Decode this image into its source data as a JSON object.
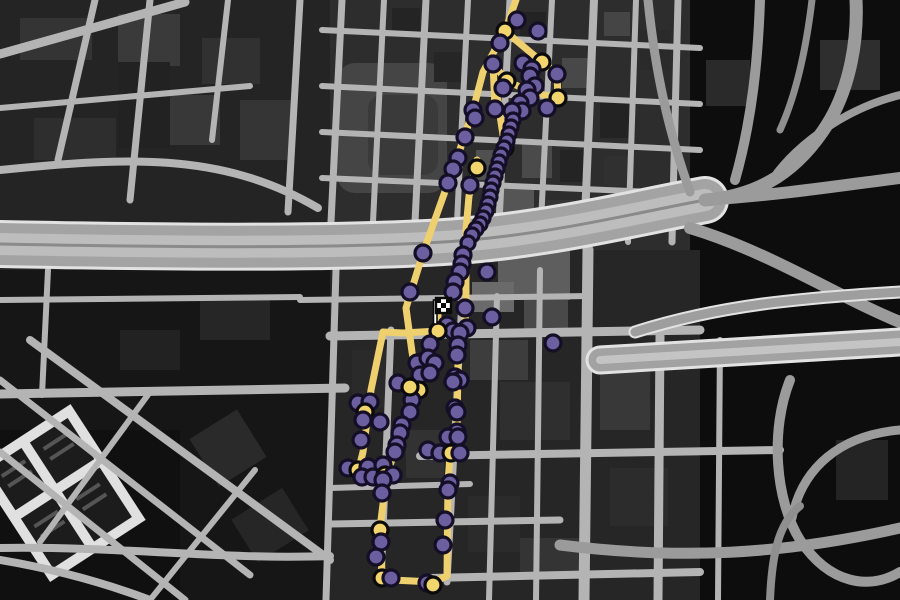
{
  "app": {
    "name": "gta-style-city-race-map",
    "view": "radar-map-fullscreen"
  },
  "map": {
    "colors": {
      "base": "#1f1f1f",
      "street": "#b4b4b4",
      "street_minor": "#a2a2a2",
      "freeway": "#a3a3a3",
      "freeway_edge": "#e2e2e2",
      "route": "#eed06f",
      "checkpoint_fill": "#6c5fa0",
      "checkpoint_stroke": "#140e27",
      "waypoint_fill": "#f3d56d",
      "waypoint_stroke": "#0b0b0b",
      "flag_white": "#ffffff",
      "flag_black": "#0a0a0a"
    },
    "flag": {
      "x": 431,
      "y": 296,
      "cols": 3,
      "rows": 3,
      "cell": 5
    },
    "route_segments": [
      [
        [
          516,
          0
        ],
        [
          505,
          31
        ],
        [
          483,
          72
        ],
        [
          473,
          110
        ],
        [
          464,
          138
        ],
        [
          448,
          183
        ],
        [
          423,
          253
        ],
        [
          406,
          308
        ],
        [
          412,
          352
        ],
        [
          419,
          388
        ]
      ],
      [
        [
          505,
          31
        ],
        [
          542,
          62
        ],
        [
          557,
          74
        ],
        [
          558,
          98
        ],
        [
          531,
          92
        ],
        [
          507,
          81
        ],
        [
          493,
          64
        ],
        [
          495,
          108
        ]
      ],
      [
        [
          497,
          96
        ],
        [
          505,
          148
        ]
      ],
      [
        [
          477,
          160
        ],
        [
          469,
          196
        ],
        [
          466,
          230
        ],
        [
          466,
          312
        ],
        [
          462,
          342
        ],
        [
          458,
          362
        ],
        [
          457,
          432
        ],
        [
          450,
          456
        ],
        [
          448,
          482
        ],
        [
          447,
          576
        ]
      ],
      [
        [
          447,
          576
        ],
        [
          433,
          582
        ],
        [
          392,
          580
        ],
        [
          382,
          574
        ],
        [
          380,
          528
        ],
        [
          384,
          496
        ],
        [
          386,
          477
        ]
      ],
      [
        [
          386,
          477
        ],
        [
          397,
          445
        ],
        [
          408,
          414
        ],
        [
          412,
          398
        ],
        [
          403,
          381
        ]
      ],
      [
        [
          383,
          332
        ],
        [
          371,
          390
        ],
        [
          363,
          452
        ],
        [
          359,
          468
        ],
        [
          370,
          474
        ],
        [
          386,
          477
        ]
      ],
      [
        [
          438,
          330
        ],
        [
          428,
          358
        ],
        [
          419,
          390
        ],
        [
          411,
          414
        ]
      ],
      [
        [
          438,
          331
        ],
        [
          403,
          333
        ],
        [
          383,
          332
        ]
      ],
      [
        [
          438,
          331
        ],
        [
          438,
          304
        ]
      ]
    ],
    "checkpoints": [
      [
        517,
        20,
        "p"
      ],
      [
        505,
        31,
        "y"
      ],
      [
        538,
        31,
        "p"
      ],
      [
        500,
        43,
        "p"
      ],
      [
        523,
        63,
        "p"
      ],
      [
        493,
        64,
        "p"
      ],
      [
        542,
        62,
        "y"
      ],
      [
        532,
        69,
        "p"
      ],
      [
        530,
        76,
        "p"
      ],
      [
        557,
        74,
        "p"
      ],
      [
        507,
        81,
        "y"
      ],
      [
        535,
        86,
        "p"
      ],
      [
        503,
        88,
        "p"
      ],
      [
        527,
        90,
        "p"
      ],
      [
        558,
        98,
        "y"
      ],
      [
        530,
        98,
        "p"
      ],
      [
        520,
        103,
        "p"
      ],
      [
        547,
        108,
        "p"
      ],
      [
        522,
        111,
        "p"
      ],
      [
        512,
        111,
        "p"
      ],
      [
        495,
        109,
        "p"
      ],
      [
        473,
        110,
        "p"
      ],
      [
        475,
        118,
        "p"
      ],
      [
        465,
        137,
        "p"
      ],
      [
        458,
        158,
        "p"
      ],
      [
        453,
        169,
        "p"
      ],
      [
        477,
        168,
        "y"
      ],
      [
        470,
        185,
        "p"
      ],
      [
        448,
        183,
        "p"
      ],
      [
        505,
        148,
        "y"
      ],
      [
        513,
        120,
        "p",
        7
      ],
      [
        511,
        127,
        "p",
        7
      ],
      [
        509,
        134,
        "p",
        7
      ],
      [
        507,
        141,
        "p",
        7
      ],
      [
        504,
        148,
        "p",
        7
      ],
      [
        501,
        155,
        "p",
        7
      ],
      [
        499,
        162,
        "p",
        7
      ],
      [
        497,
        169,
        "p",
        7
      ],
      [
        495,
        176,
        "p",
        7
      ],
      [
        493,
        183,
        "p",
        7
      ],
      [
        491,
        190,
        "p",
        7
      ],
      [
        490,
        197,
        "p",
        7
      ],
      [
        488,
        204,
        "p",
        7
      ],
      [
        486,
        211,
        "p",
        7
      ],
      [
        483,
        218,
        "p",
        7
      ],
      [
        480,
        224,
        "p",
        7
      ],
      [
        476,
        229,
        "p",
        7
      ],
      [
        472,
        235,
        "p",
        7
      ],
      [
        468,
        243,
        "p",
        7
      ],
      [
        463,
        255,
        "p"
      ],
      [
        462,
        264,
        "p"
      ],
      [
        460,
        272,
        "p"
      ],
      [
        455,
        282,
        "p"
      ],
      [
        453,
        292,
        "p"
      ],
      [
        487,
        272,
        "p"
      ],
      [
        423,
        253,
        "p"
      ],
      [
        410,
        292,
        "p"
      ],
      [
        492,
        317,
        "p"
      ],
      [
        465,
        308,
        "p"
      ],
      [
        467,
        328,
        "p"
      ],
      [
        447,
        325,
        "p"
      ],
      [
        453,
        331,
        "p"
      ],
      [
        438,
        331,
        "y"
      ],
      [
        430,
        344,
        "p"
      ],
      [
        422,
        362,
        "p"
      ],
      [
        417,
        363,
        "p"
      ],
      [
        428,
        358,
        "p"
      ],
      [
        435,
        363,
        "p"
      ],
      [
        420,
        375,
        "p"
      ],
      [
        430,
        373,
        "p"
      ],
      [
        419,
        390,
        "y"
      ],
      [
        412,
        400,
        "p"
      ],
      [
        410,
        412,
        "p"
      ],
      [
        553,
        343,
        "p"
      ],
      [
        398,
        383,
        "p"
      ],
      [
        410,
        387,
        "y"
      ],
      [
        402,
        425,
        "p"
      ],
      [
        400,
        433,
        "p"
      ],
      [
        397,
        445,
        "p"
      ],
      [
        395,
        452,
        "p"
      ],
      [
        460,
        333,
        "p"
      ],
      [
        458,
        345,
        "p"
      ],
      [
        457,
        355,
        "p"
      ],
      [
        455,
        377,
        "p"
      ],
      [
        460,
        380,
        "p"
      ],
      [
        453,
        382,
        "p"
      ],
      [
        455,
        408,
        "p"
      ],
      [
        457,
        412,
        "p"
      ],
      [
        457,
        432,
        "p"
      ],
      [
        448,
        437,
        "p"
      ],
      [
        458,
        437,
        "p"
      ],
      [
        428,
        450,
        "p"
      ],
      [
        440,
        453,
        "p"
      ],
      [
        451,
        453,
        "y"
      ],
      [
        460,
        453,
        "p"
      ],
      [
        358,
        403,
        "p"
      ],
      [
        370,
        402,
        "p"
      ],
      [
        365,
        412,
        "y"
      ],
      [
        363,
        420,
        "p"
      ],
      [
        380,
        422,
        "p"
      ],
      [
        361,
        440,
        "p"
      ],
      [
        348,
        468,
        "p"
      ],
      [
        358,
        470,
        "y"
      ],
      [
        368,
        467,
        "p"
      ],
      [
        362,
        477,
        "p"
      ],
      [
        373,
        477,
        "p"
      ],
      [
        383,
        465,
        "p"
      ],
      [
        385,
        475,
        "y"
      ],
      [
        393,
        475,
        "p"
      ],
      [
        383,
        480,
        "p"
      ],
      [
        382,
        493,
        "p"
      ],
      [
        380,
        530,
        "y"
      ],
      [
        381,
        542,
        "p"
      ],
      [
        376,
        557,
        "p"
      ],
      [
        382,
        578,
        "y"
      ],
      [
        391,
        578,
        "p"
      ],
      [
        427,
        583,
        "p"
      ],
      [
        433,
        585,
        "y"
      ],
      [
        450,
        483,
        "p"
      ],
      [
        448,
        490,
        "p"
      ],
      [
        445,
        520,
        "p"
      ],
      [
        443,
        545,
        "p"
      ]
    ]
  }
}
